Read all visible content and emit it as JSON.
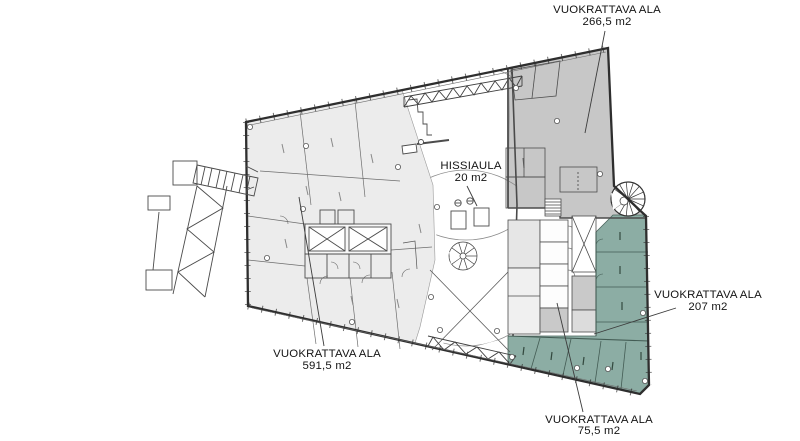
{
  "page": {
    "background": "#ffffff",
    "kind": "architectural floor plan"
  },
  "colors": {
    "area_light": "#ececec",
    "area_gray": "#c7c7c7",
    "area_teal": "#8cada4",
    "core_gray": "#c9c9c9",
    "core_gray_light": "#dcdcdc",
    "room_light": "#e6e6e6",
    "outline": "#2e2e2e",
    "line": "#5a5a5a",
    "thin_line": "#8a8a8a",
    "leader": "#3c3c3c",
    "text": "#141414"
  },
  "areas": [
    {
      "label": "VUOKRATTAVA ALA",
      "value": "266,5 m2",
      "location": "top-right",
      "shade": "gray"
    },
    {
      "label": "HISSIAULA",
      "value": "20 m2",
      "location": "center",
      "shade": "white"
    },
    {
      "label": "VUOKRATTAVA ALA",
      "value": "207 m2",
      "location": "right",
      "shade": "teal"
    },
    {
      "label": "VUOKRATTAVA ALA",
      "value": "591,5 m2",
      "location": "bottom-left",
      "shade": "light-gray"
    },
    {
      "label": "VUOKRATTAVA ALA",
      "value": "75,5 m2",
      "location": "bottom",
      "shade": "teal"
    }
  ]
}
